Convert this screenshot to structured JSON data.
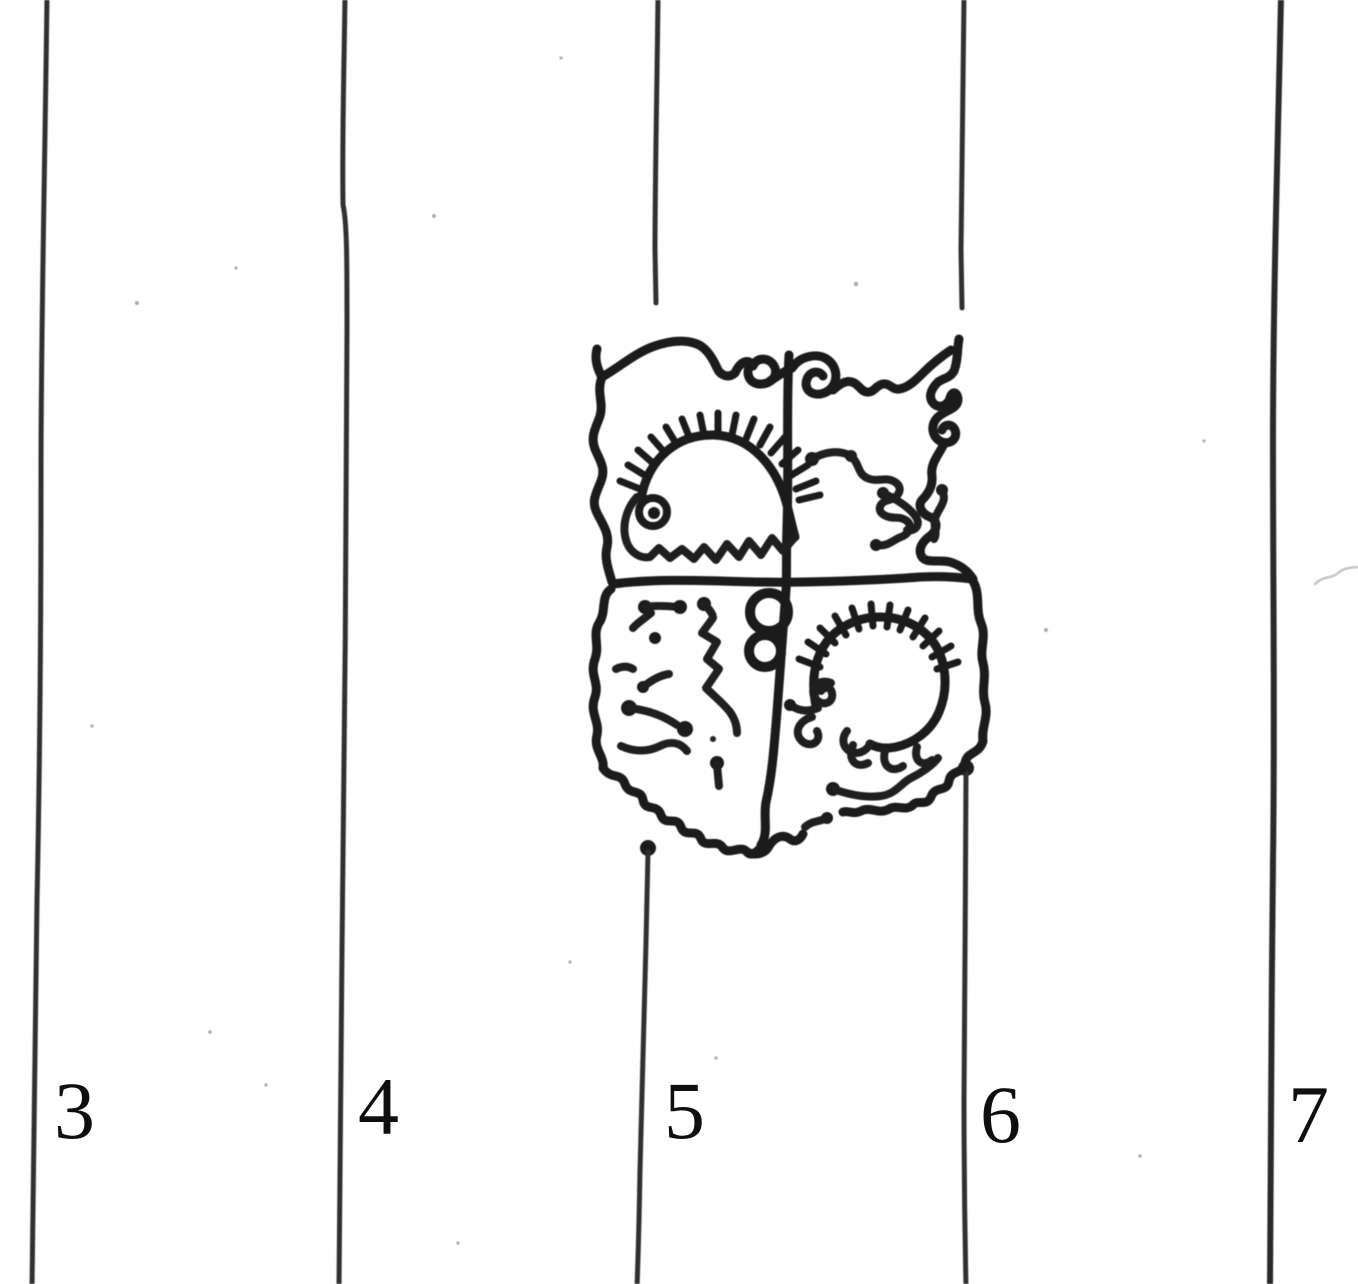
{
  "labels": [
    {
      "text": "3"
    },
    {
      "text": "4"
    },
    {
      "text": "5"
    },
    {
      "text": "6"
    },
    {
      "text": "7"
    }
  ],
  "colors": {
    "paper": "#ffffff",
    "ink": "#1b1b1b",
    "ruled_line": "#303030",
    "label_text": "#0f0f0f"
  },
  "watermark": {
    "motifs": [
      "quartered-shield",
      "spiral-crest-top",
      "hedgehog-upper-left",
      "scribble-creature-upper-right",
      "lion-scribble-lower-left",
      "double-rings-center",
      "hedgehog-lower-right"
    ]
  }
}
